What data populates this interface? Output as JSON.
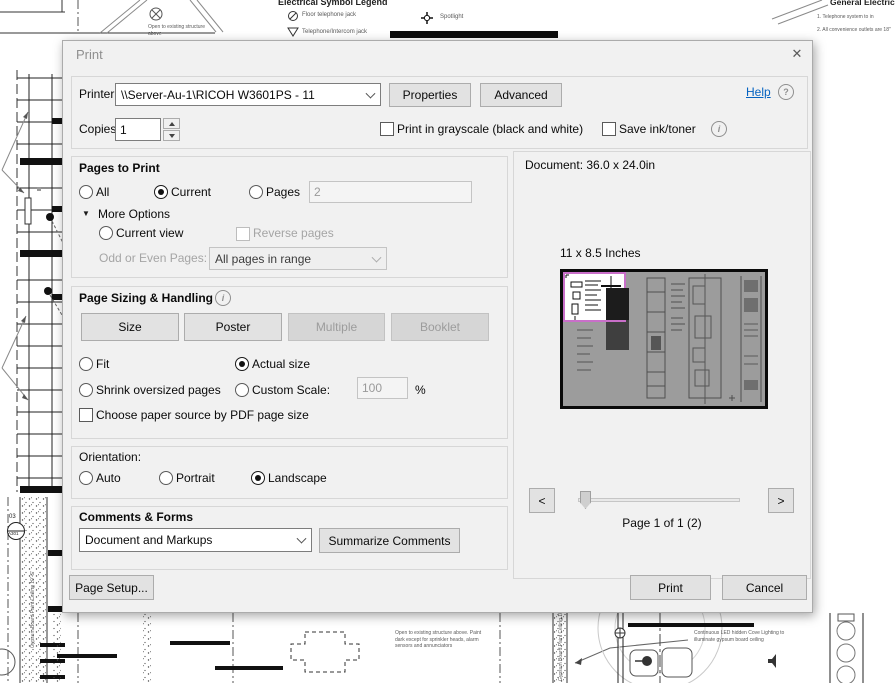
{
  "window": {
    "title": "Print",
    "close_icon": "✕"
  },
  "printer": {
    "label": "Printer:",
    "value": "\\\\Server-Au-1\\RICOH W3601PS - 11",
    "properties_button": "Properties",
    "advanced_button": "Advanced",
    "help_link": "Help",
    "help_icon": "?",
    "copies_label": "Copies:",
    "copies_value": "1",
    "grayscale_label": "Print in grayscale (black and white)",
    "save_ink_label": "Save ink/toner",
    "info_icon": "i"
  },
  "pages_to_print": {
    "title": "Pages to Print",
    "all_label": "All",
    "current_label": "Current",
    "pages_label": "Pages",
    "pages_value": "2",
    "more_options_icon": "▼",
    "more_options_label": "More Options",
    "current_view_label": "Current view",
    "reverse_pages_label": "Reverse pages",
    "odd_even_label": "Odd or Even Pages:",
    "odd_even_value": "All pages in range"
  },
  "page_sizing": {
    "title": "Page Sizing & Handling",
    "info_icon": "i",
    "size_button": "Size",
    "poster_button": "Poster",
    "multiple_button": "Multiple",
    "booklet_button": "Booklet",
    "fit_label": "Fit",
    "actual_size_label": "Actual size",
    "shrink_label": "Shrink oversized pages",
    "custom_scale_label": "Custom Scale:",
    "custom_scale_value": "100",
    "percent_label": "%",
    "paper_source_label": "Choose paper source by PDF page size"
  },
  "orientation": {
    "title": "Orientation:",
    "auto_label": "Auto",
    "portrait_label": "Portrait",
    "landscape_label": "Landscape"
  },
  "comments": {
    "title": "Comments & Forms",
    "dropdown_value": "Document and Markups",
    "summarize_button": "Summarize Comments"
  },
  "preview": {
    "document_size": "Document: 36.0 x 24.0in",
    "paper_size": "11 x 8.5 Inches",
    "prev_icon": "<",
    "next_icon": ">",
    "page_status": "Page 1 of 1 (2)"
  },
  "footer": {
    "page_setup_button": "Page Setup...",
    "print_button": "Print",
    "cancel_button": "Cancel"
  },
  "colors": {
    "help_link": "#0563c1",
    "preview_highlight_border": "#c96fc9",
    "preview_page_fill": "#9c9c9c"
  },
  "background": {
    "legend_title": "Electrical Symbol Legend",
    "legend_item_1": "Floor telephone jack",
    "legend_item_2": "Spotlight",
    "legend_item_3": "Telephone/Intercom jack",
    "open_note": "Open to existing structure above",
    "notes_title": "General Electrical N",
    "note1": "1. Telephone system to        in",
    "note2": "2. All convenience outlets are 18\"",
    "paint_note": "Open to existing structure above. Paint dark except for sprinkler heads, alarm sensors and annunciators",
    "cove_note": "Continuous LED hidden Cove Lighting to illuminate gypsum board ceiling",
    "ceiling_label": "Gypsum Board Paint Ceiling 10'-6\"",
    "section_marker_top": "03",
    "section_marker_bottom": "A301"
  }
}
